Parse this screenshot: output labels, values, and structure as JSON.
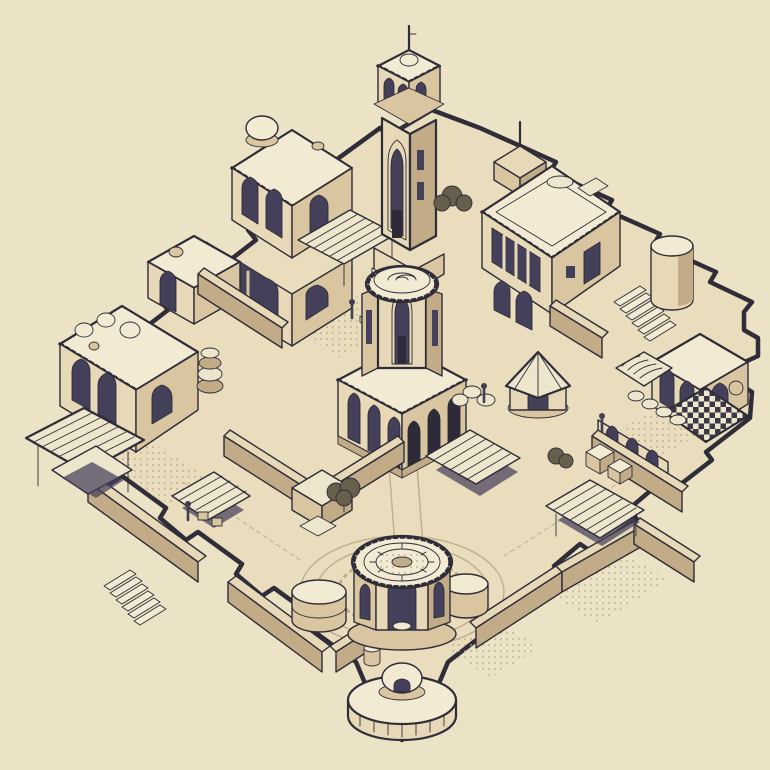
{
  "scene": {
    "type": "isometric-illustration",
    "subject": "walled-desert-town-map",
    "background": "#ece3c7",
    "figure_count": 4,
    "landmarks": [
      "town-plate",
      "minaret-tower",
      "dome-house",
      "small-house",
      "pot-house",
      "courtyard-house",
      "round-tower",
      "arch-house",
      "central-pavilion",
      "fountain-pavilion",
      "plaza-rings",
      "water-cistern",
      "corner-bastion",
      "striped-awning",
      "market-stall",
      "round-tent",
      "checkered-canopy",
      "ribbed-vault",
      "pergola",
      "slat-canopy",
      "town-wall",
      "stairs",
      "crates",
      "sacks",
      "jars",
      "tree",
      "townsfolk"
    ]
  },
  "palette": {
    "bg": "#ece3c7",
    "plate": "#e9ddbe",
    "roof": "#f2ead3",
    "wall": "#e7d9b7",
    "wall2": "#d9c6a1",
    "wall3": "#c2ab87",
    "deep": "#a2876a",
    "line": "#2f2d38",
    "arch": "#45405a",
    "arch2": "#2e2a3a",
    "canvas": "#ede5cc",
    "foliage": "#665f4c",
    "ink": "#443f50",
    "pathln": "#bfae8a",
    "dot": "#b9a683",
    "check": "#3c3848"
  }
}
